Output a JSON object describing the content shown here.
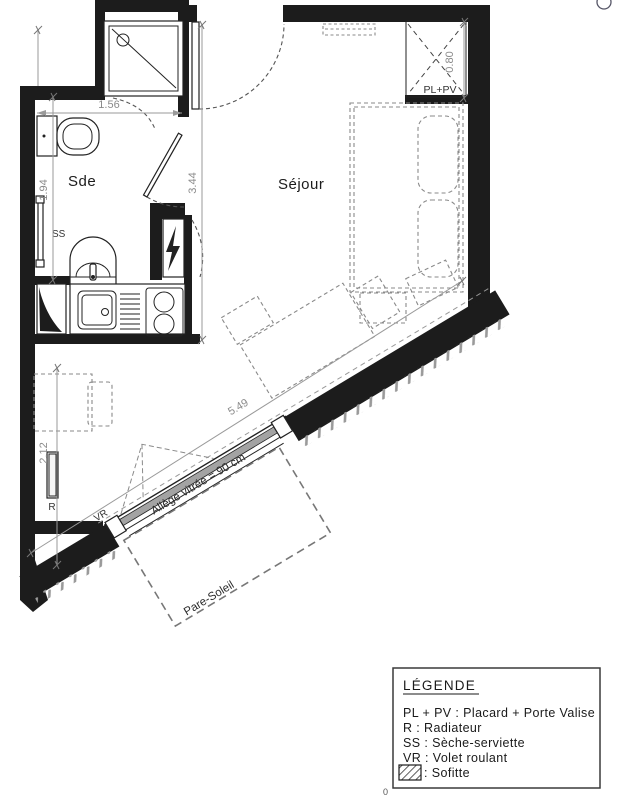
{
  "plan": {
    "rooms": {
      "bathroom": "Sde",
      "living": "Séjour"
    },
    "dims": {
      "bath_width": "1.56",
      "bath_height": "1.94",
      "hall_length": "3.44",
      "lower_wall": "2.12",
      "closet_width": "0.80",
      "window_length": "5.49"
    },
    "labels": {
      "roller_shutter": "VR",
      "towel_dryer": "SS",
      "radiator": "R",
      "closet": "PL+PV",
      "window_sill": "Allège vitrée = 90 cm",
      "sunshade": "Pare-Soleil"
    },
    "stray_mark": "0"
  },
  "legend": {
    "title": "LÉGENDE",
    "items": [
      "PL + PV : Placard + Porte Valise",
      "R : Radiateur",
      "SS : Sèche-serviette",
      "VR : Volet roulant"
    ],
    "hatch_item": ": Sofitte"
  },
  "colors": {
    "wall": "#1c1c1c",
    "furniture_dash": "#8a8a8a",
    "dimension": "#9a9a9a",
    "glazing": "#a3a3a3",
    "text": "#1a1a1a"
  }
}
